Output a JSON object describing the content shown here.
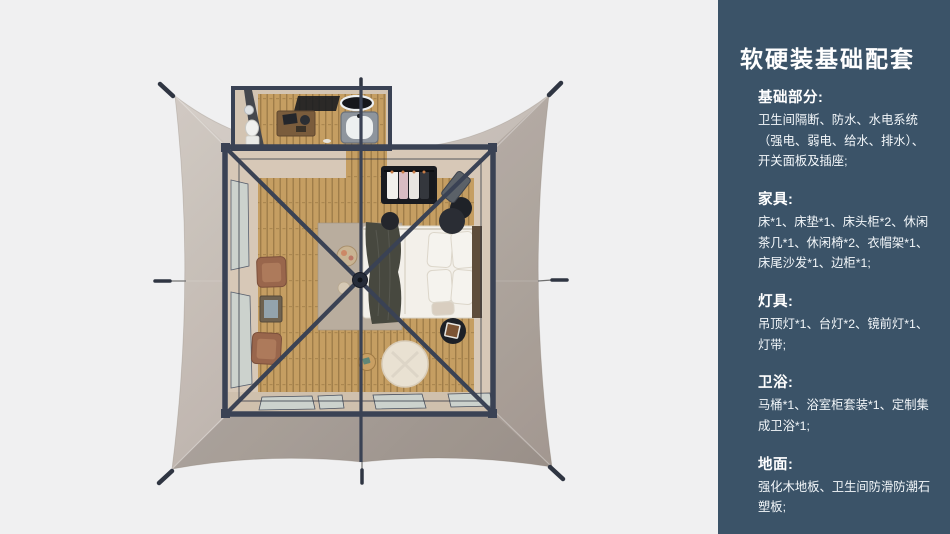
{
  "page": {
    "width": 950,
    "height": 534,
    "background": "#f0f0f1"
  },
  "theme": {
    "panel_bg": "#3b5368",
    "panel_text": "#f3f7fa",
    "bg": "#f0f0f1",
    "canopy": "#c6bdb6",
    "frame": "#3a4254",
    "wood": "#c59e62",
    "beige": "#d7c8b7",
    "glass": "#ccd2cd",
    "bedding": "#f3f0ea",
    "throw": "#47483f",
    "leather": "#99664c",
    "pouf": "#e9e1d2",
    "dark": "#22252b",
    "rug": "#b9ad9e"
  },
  "panel": {
    "title": "软硬装基础配套",
    "sections": [
      {
        "heading": "基础部分:",
        "body": "卫生间隔断、防水、水电系统（强电、弱电、给水、排水）、开关面板及插座;"
      },
      {
        "heading": "家具:",
        "body": "床*1、床垫*1、床头柜*2、休闲茶几*1、休闲椅*2、衣帽架*1、床尾沙发*1、边柜*1;"
      },
      {
        "heading": "灯具:",
        "body": "吊顶灯*1、台灯*2、镜前灯*1、灯带;"
      },
      {
        "heading": "卫浴:",
        "body": "马桶*1、浴室柜套装*1、定制集成卫浴*1;"
      },
      {
        "heading": "地面:",
        "body": "强化木地板、卫生间防滑防潮石塑板;"
      }
    ]
  }
}
